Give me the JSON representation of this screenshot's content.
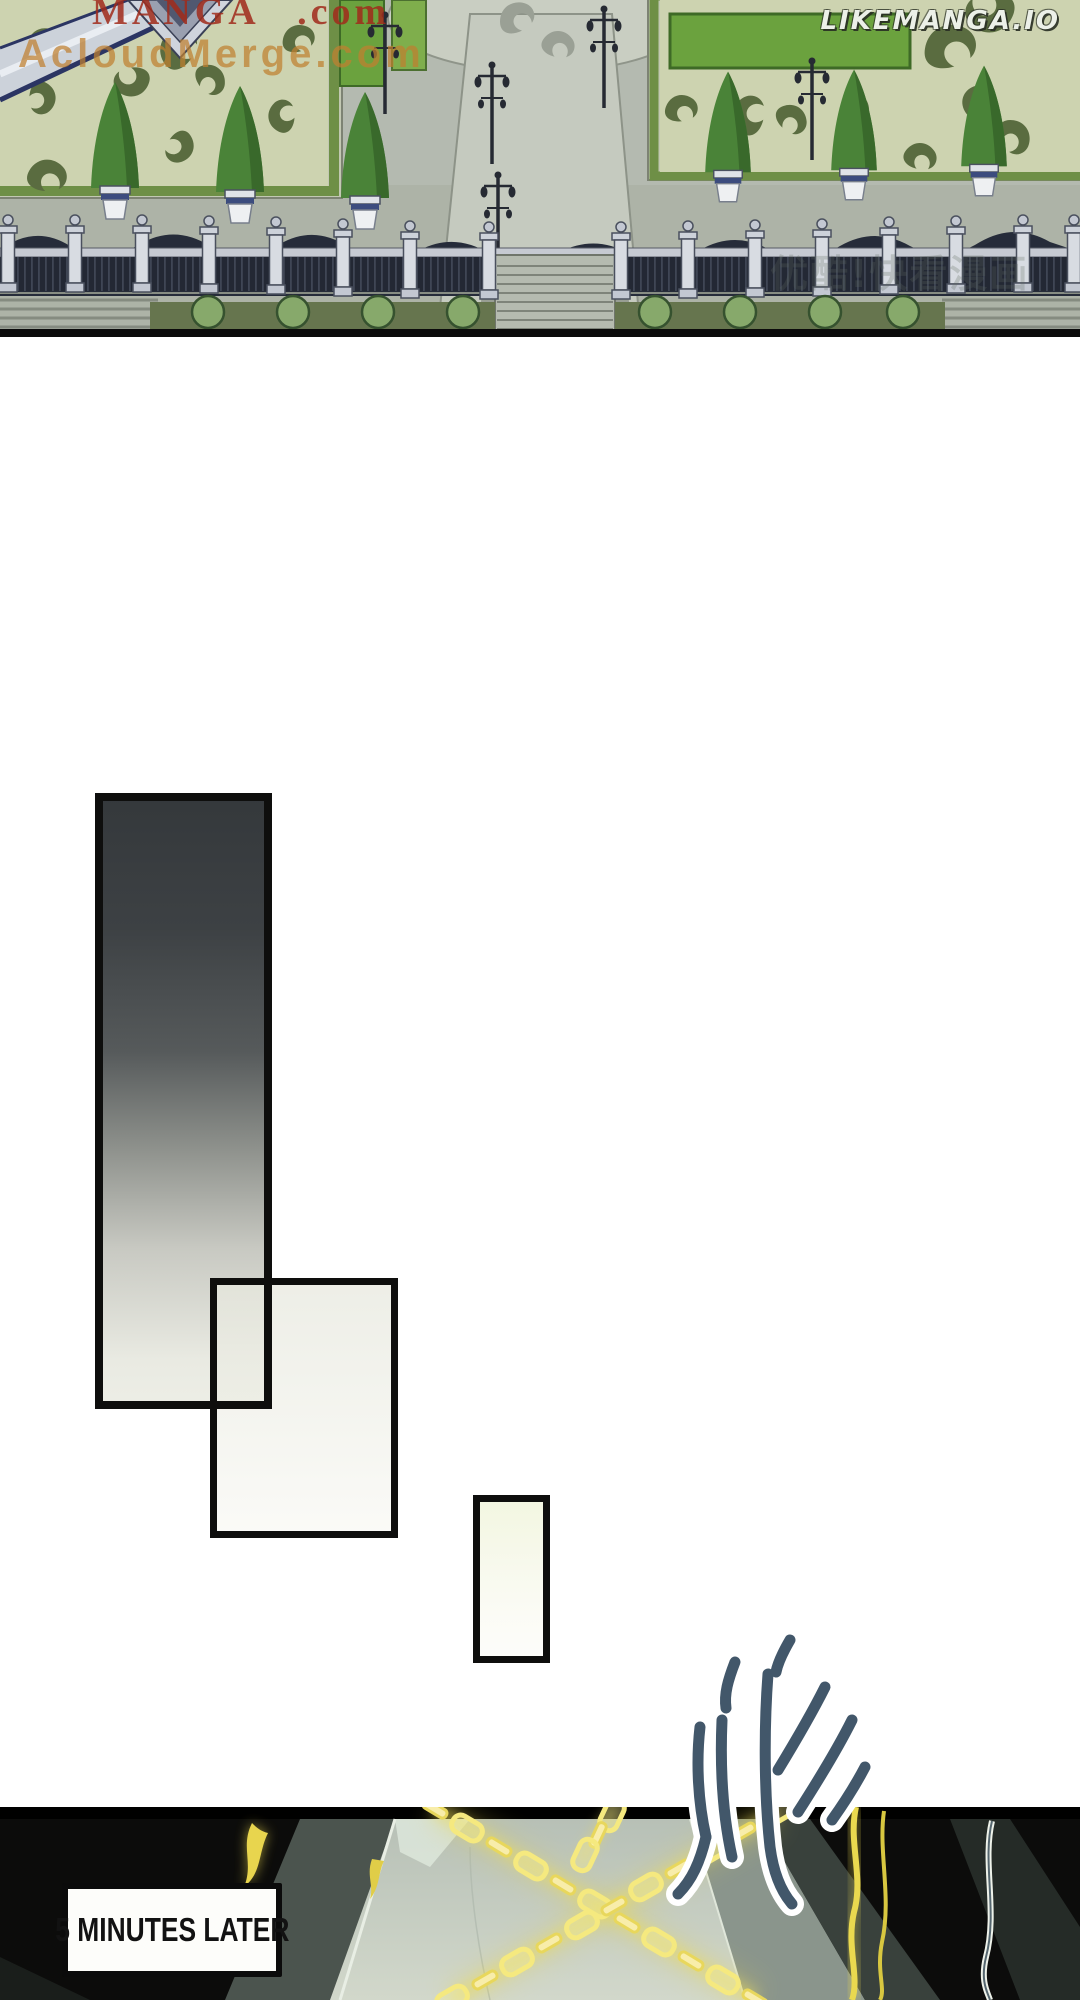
{
  "watermarks": {
    "top_left_line1": "MANGA .com",
    "top_left_line2": "AcloudMerge.com",
    "site": "LIKEMANGA.IO",
    "faint_overlay": "优酷!快看漫画"
  },
  "panels": {
    "caption": {
      "text": "5 MINUTES LATER"
    },
    "sfx": {
      "text": "哗"
    }
  },
  "colors": {
    "watermark_red": "#a12b1b",
    "watermark_orange": "#c08030",
    "site_text": "#ecf0e8",
    "chain_yellow": "#f5e97f",
    "panel_black": "#0c0c0b",
    "garden_green": "#5a6c40"
  }
}
